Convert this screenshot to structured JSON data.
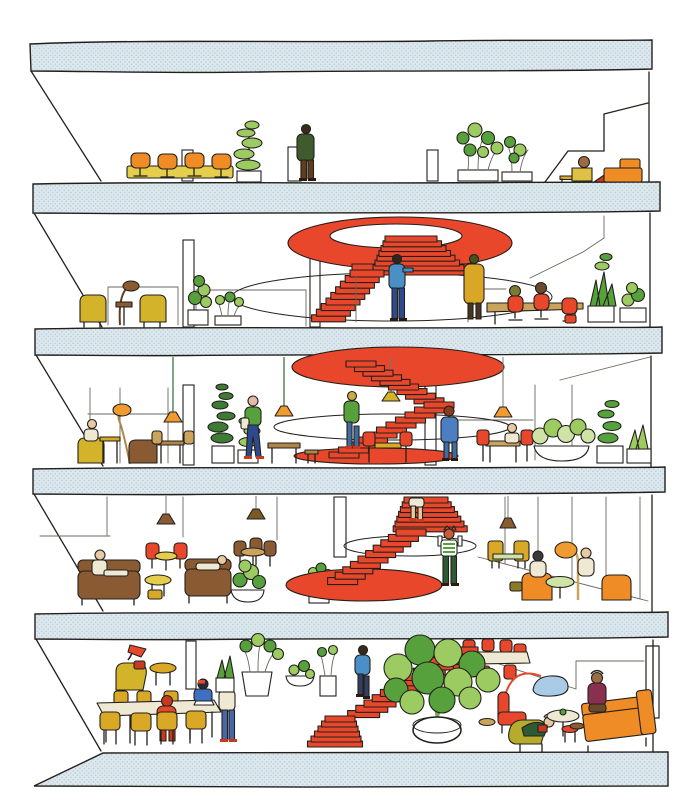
{
  "illustration": {
    "title": "Hand-drawn architectural cross-section of a five-storey building with red stairs, plants, furniture and people",
    "style": "ink outline with flat color fills, stippled blue-grey floor slabs",
    "palette": {
      "paper": "#ffffff",
      "ink": "#23201c",
      "slab_fill": "#dce8ed",
      "slab_dot": "#b7cdd8",
      "red": "#e8472b",
      "red_deep": "#c73a1d",
      "orange": "#ef8c26",
      "orange_shade": "#f09b30",
      "amber_coat": "#d9a625",
      "yellow": "#d3b32a",
      "mustard": "#d8a826",
      "yellow_table": "#e6ce4d",
      "cream": "#efe8d2",
      "tan": "#caa45c",
      "wood": "#b08548",
      "brown": "#8a5a33",
      "brown_dark": "#5f3d1f",
      "green": "#57a13d",
      "green_light": "#9ccb62",
      "green_pale": "#cfe3a6",
      "green_dark": "#2f6b2f",
      "olive": "#b5ab2c",
      "olive_dark": "#7a7a33",
      "blue": "#4b8fc7",
      "navy": "#2e4a8f",
      "denim": "#4668a8",
      "steel": "#33415f",
      "blue_pond": "#a9cbe6",
      "skin": "#e9c9a2",
      "skin_dark": "#9c6b43",
      "line_soft": "#6b675f"
    },
    "floors": [
      {
        "id": "floor-5",
        "label": "Top floor terrace",
        "features": [
          "yellow conference table with four orange chairs",
          "tall stacked-leaf plant",
          "standing person in dark green coat",
          "planter bushes",
          "person seated at low yellow desk",
          "orange sofa",
          "sloped glass corner"
        ]
      },
      {
        "id": "floor-4",
        "label": "Fourth floor",
        "features": [
          "red ceiling oval with white stair opening",
          "red stair with landing",
          "two people leaning on stair railing",
          "two yellow armchairs with arc lamp",
          "potted plants",
          "meeting table with red chairs and two hooded people",
          "aloe and bush planters"
        ]
      },
      {
        "id": "floor-3",
        "label": "Third floor",
        "features": [
          "solid red ceiling oval",
          "switchback red stair",
          "person climbing stair",
          "four pendant lamps",
          "reading nook with yellow and brown armchairs",
          "person walking with tote bag",
          "red dining chairs and tables",
          "person standing in blue coat",
          "large planter bowls"
        ]
      },
      {
        "id": "floor-2",
        "label": "Second floor",
        "features": [
          "red stair descending onto red floor oval",
          "bare legs of person on upper flight",
          "person in striped shirt taking photo",
          "two brown sofas with resting people",
          "cafe tables with red and brown chairs",
          "pendant lamps",
          "orange armchairs with two seated people and arc lamp"
        ]
      },
      {
        "id": "floor-1",
        "label": "Ground floor",
        "features": [
          "long cream communal table with mustard chairs",
          "person in red hoodie seated",
          "person in blue with laptop",
          "standing person in white top and jeans",
          "yellow lounge chair with red lamp",
          "potted plant cluster",
          "long red stair with descending person",
          "large indoor tree in round pot",
          "cream table with red chairs behind tree",
          "small blue pond with red arc lamp",
          "red armchair",
          "olive lounge chair with reading person",
          "orange sofa with seated person",
          "door frame in right wall"
        ]
      }
    ],
    "people": [
      {
        "floor": "floor-5",
        "activity": "standing by panel"
      },
      {
        "floor": "floor-5",
        "activity": "seated at low desk"
      },
      {
        "floor": "floor-4",
        "activity": "leaning on stair railing (blue)"
      },
      {
        "floor": "floor-4",
        "activity": "leaning on stair railing (ochre coat)"
      },
      {
        "floor": "floor-4",
        "activity": "seated at meeting table (olive hood)"
      },
      {
        "floor": "floor-4",
        "activity": "seated at meeting table (brown hood)"
      },
      {
        "floor": "floor-3",
        "activity": "climbing stair"
      },
      {
        "floor": "floor-3",
        "activity": "walking with tote"
      },
      {
        "floor": "floor-3",
        "activity": "seated in yellow chair"
      },
      {
        "floor": "floor-3",
        "activity": "standing in blue coat"
      },
      {
        "floor": "floor-3",
        "activity": "seated at table"
      },
      {
        "floor": "floor-2",
        "activity": "descending stair (legs visible)"
      },
      {
        "floor": "floor-2",
        "activity": "standing on red oval taking photo"
      },
      {
        "floor": "floor-2",
        "activity": "sitting on sofa"
      },
      {
        "floor": "floor-2",
        "activity": "lying on sofa"
      },
      {
        "floor": "floor-2",
        "activity": "seated in orange armchair (left)"
      },
      {
        "floor": "floor-2",
        "activity": "seated in orange armchair (right)"
      },
      {
        "floor": "floor-1",
        "activity": "working on laptop"
      },
      {
        "floor": "floor-1",
        "activity": "seated in red hoodie"
      },
      {
        "floor": "floor-1",
        "activity": "standing by table"
      },
      {
        "floor": "floor-1",
        "activity": "descending stair"
      },
      {
        "floor": "floor-1",
        "activity": "reading in lounge chair"
      },
      {
        "floor": "floor-1",
        "activity": "seated on orange sofa"
      }
    ],
    "stairs": [
      {
        "group": "stair-f4-frontal",
        "x0": 385,
        "y0": 236,
        "dx": -2,
        "dy": 4.8,
        "w0": 52,
        "dw": 6.5,
        "h": 6,
        "n": 7
      },
      {
        "group": "stair-f4-side",
        "x0": 350,
        "y0": 270,
        "dx": -4.8,
        "dy": 5.6,
        "w0": 34,
        "dw": 0,
        "h": 7,
        "n": 9
      },
      {
        "group": "stair-f3-upper",
        "x0": 346,
        "y0": 361,
        "dx": 8.5,
        "dy": 4.6,
        "w0": 30,
        "dw": 0,
        "h": 6,
        "n": 9
      },
      {
        "group": "stair-f3-lower",
        "x0": 424,
        "y0": 402,
        "dx": -9.5,
        "dy": 5.0,
        "w0": 30,
        "dw": 0,
        "h": 6,
        "n": 11
      },
      {
        "group": "stair-f2-frontal",
        "x0": 404,
        "y0": 497,
        "dx": -1.8,
        "dy": 4.8,
        "w0": 44,
        "dw": 5,
        "h": 6,
        "n": 7
      },
      {
        "group": "stair-f2-side",
        "x0": 396,
        "y0": 529,
        "dx": -7.6,
        "dy": 5.4,
        "w0": 30,
        "dw": 0,
        "h": 7,
        "n": 10
      },
      {
        "group": "stair-f1-long",
        "x0": 446,
        "y0": 647,
        "dx": -8.2,
        "dy": 5.3,
        "w0": 32,
        "dw": 0,
        "h": 7,
        "n": 13
      },
      {
        "group": "stair-f1-bottom",
        "x0": 325,
        "y0": 716,
        "dx": -3.5,
        "dy": 5,
        "w0": 30,
        "dw": 5,
        "h": 6,
        "n": 6
      }
    ]
  }
}
